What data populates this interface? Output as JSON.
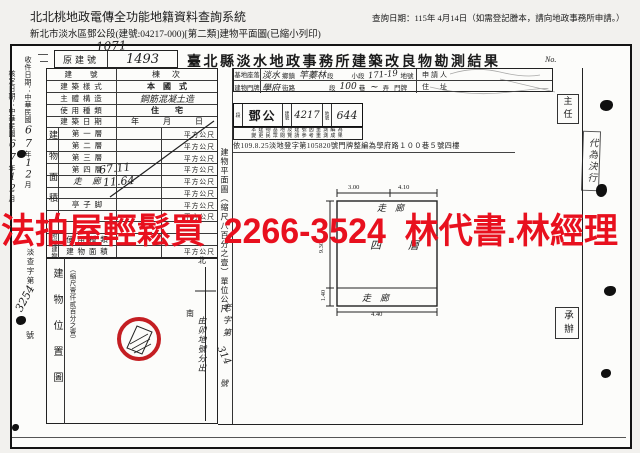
{
  "app": {
    "title": "北北桃地政電傳全功能地籍資料查詢系統",
    "subtitle": "新北市淡水區鄧公段(建號:04217-000)[第二類]建物平面圖(已縮小列印)",
    "query_date": "查詢日期：115年 4月14日（如需登記謄本，請向地政事務所申請。）"
  },
  "doc": {
    "no_label": "No.",
    "title": "臺北縣淡水地政事務所建築改良物勘測結果",
    "old_no": {
      "label": "原建號",
      "hw_above": "1071",
      "value": "1493"
    },
    "margin": {
      "receive_label": "收件日期：中華民國",
      "approve_label": "核定日期：中華民國",
      "hw_year": "67",
      "year_unit": "年",
      "hw_month": "12",
      "month_unit": "月",
      "doc_no_prefix": "淡查字第",
      "doc_no_hw": "3254",
      "doc_no_suffix": "號"
    },
    "form": {
      "rows": {
        "bno": {
          "label": "建　　號",
          "extra": "棟　次"
        },
        "style": {
          "label": "建 築 樣 式",
          "value": "本　國　式"
        },
        "structure": {
          "label": "主 體 構 造",
          "value": "鋼筋混凝土造"
        },
        "use": {
          "label": "使 用 種 類",
          "value": "住　　宅"
        },
        "date": {
          "label": "建 築 日 期",
          "value": "年　　　月　　　日"
        }
      },
      "area_group_label": "建物面積",
      "floors": [
        {
          "label": "第 一 層",
          "value": "",
          "unit": "平方公尺"
        },
        {
          "label": "第 二 層",
          "value": "",
          "unit": "平方公尺"
        },
        {
          "label": "第 三 層",
          "value": "",
          "unit": "平方公尺"
        },
        {
          "label": "第 四 層",
          "value": "67.11",
          "unit": "平方公尺"
        },
        {
          "label": "走　廊",
          "value": "11.64",
          "unit": "平方公尺"
        },
        {
          "label": "",
          "value": "",
          "unit": "平方公尺"
        },
        {
          "label": "亭 子 脚",
          "value": "",
          "unit": "平方公尺"
        },
        {
          "label": "",
          "value": "",
          "unit": "平方公尺"
        },
        {
          "label": "",
          "value": "",
          "unit": ""
        }
      ],
      "annex_group_label": "附屬建物",
      "annex": [
        {
          "label": "使 用 種 類",
          "unit": ""
        },
        {
          "label": "建 物 面 積",
          "unit": "平方公尺"
        }
      ]
    },
    "site": {
      "label": "基地座落",
      "hw_town": "淡水",
      "town_unit": "鄉鎮",
      "hw_section": "竿蓁林",
      "section_unit": "段",
      "subsection_unit": "小段",
      "hw_parcel": "171-19",
      "parcel_unit": "地號"
    },
    "door": {
      "label": "建物門牌",
      "hw_street": "學府",
      "street_unit": "街路",
      "section_unit": "段",
      "hw_lane": "100",
      "lane_unit": "巷",
      "hw_mark": "~",
      "alley_unit": "弄",
      "plate_unit": "門牌"
    },
    "applicant_label": "申請人",
    "address_label": "住　址",
    "resurvey": {
      "section_label": "段",
      "section_hw": "鄧公",
      "bno_label": "建號",
      "bno_hw": "4217",
      "pno_label": "地號",
      "pno_hw": "644",
      "stamp_line1": "本建物基地及建號因重測編為",
      "stamp_line2": "變更民眾閱覽請參考重測成果",
      "note": "依109.8.25淡地登字第105820號門牌整編為學府路１００巷５號四樓"
    },
    "strip_label": "建物平面圖（縮尺八百分之壹）單位公尺",
    "pos_map": {
      "label": "建物位置圖",
      "scale": "（縮尺壹仟貳百分之壹）",
      "north": "北",
      "south": "南",
      "hw_origin": "由卯地號分出",
      "hw_doc_prefix": "老字第",
      "hw_doc_no": "314",
      "hw_doc_suffix": "號"
    },
    "plan": {
      "top_label": "走　廊",
      "mid_label": "四　層",
      "bottom_label": "走　廊",
      "dim_top_left": "3.00",
      "dim_top_right": "4.10",
      "dim_left": "9.30",
      "dim_left_bottom": "1.40",
      "dim_bottom": "4.40"
    },
    "officials": {
      "chief": "主任",
      "delegate_stamp": "代為決行",
      "handler": "承辦"
    },
    "watermark": {
      "text": "法拍屋輕鬆買  2266-3524  林代書.林經理",
      "color": "#e8101e"
    }
  }
}
